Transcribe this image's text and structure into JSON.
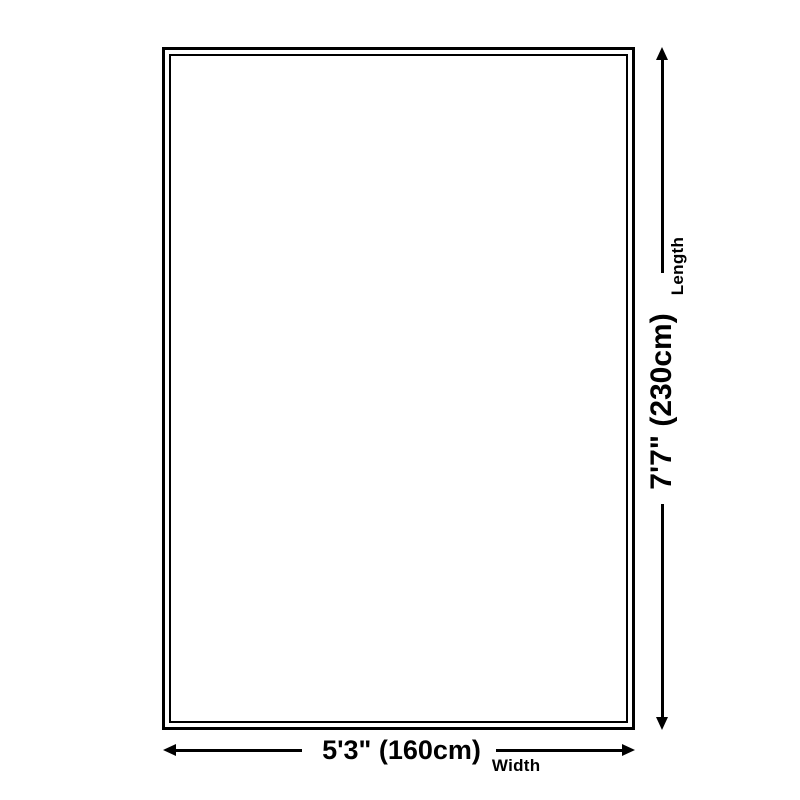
{
  "diagram": {
    "type": "product-dimensions",
    "shape": "rectangle-double-border",
    "dimensions": {
      "horizontal": {
        "value": "5'3\" (160cm)",
        "label": "Width"
      },
      "vertical": {
        "value": "7'7\" (230cm)",
        "label": "Length"
      }
    }
  },
  "colors": {
    "line": "#000000",
    "background": "#ffffff"
  }
}
